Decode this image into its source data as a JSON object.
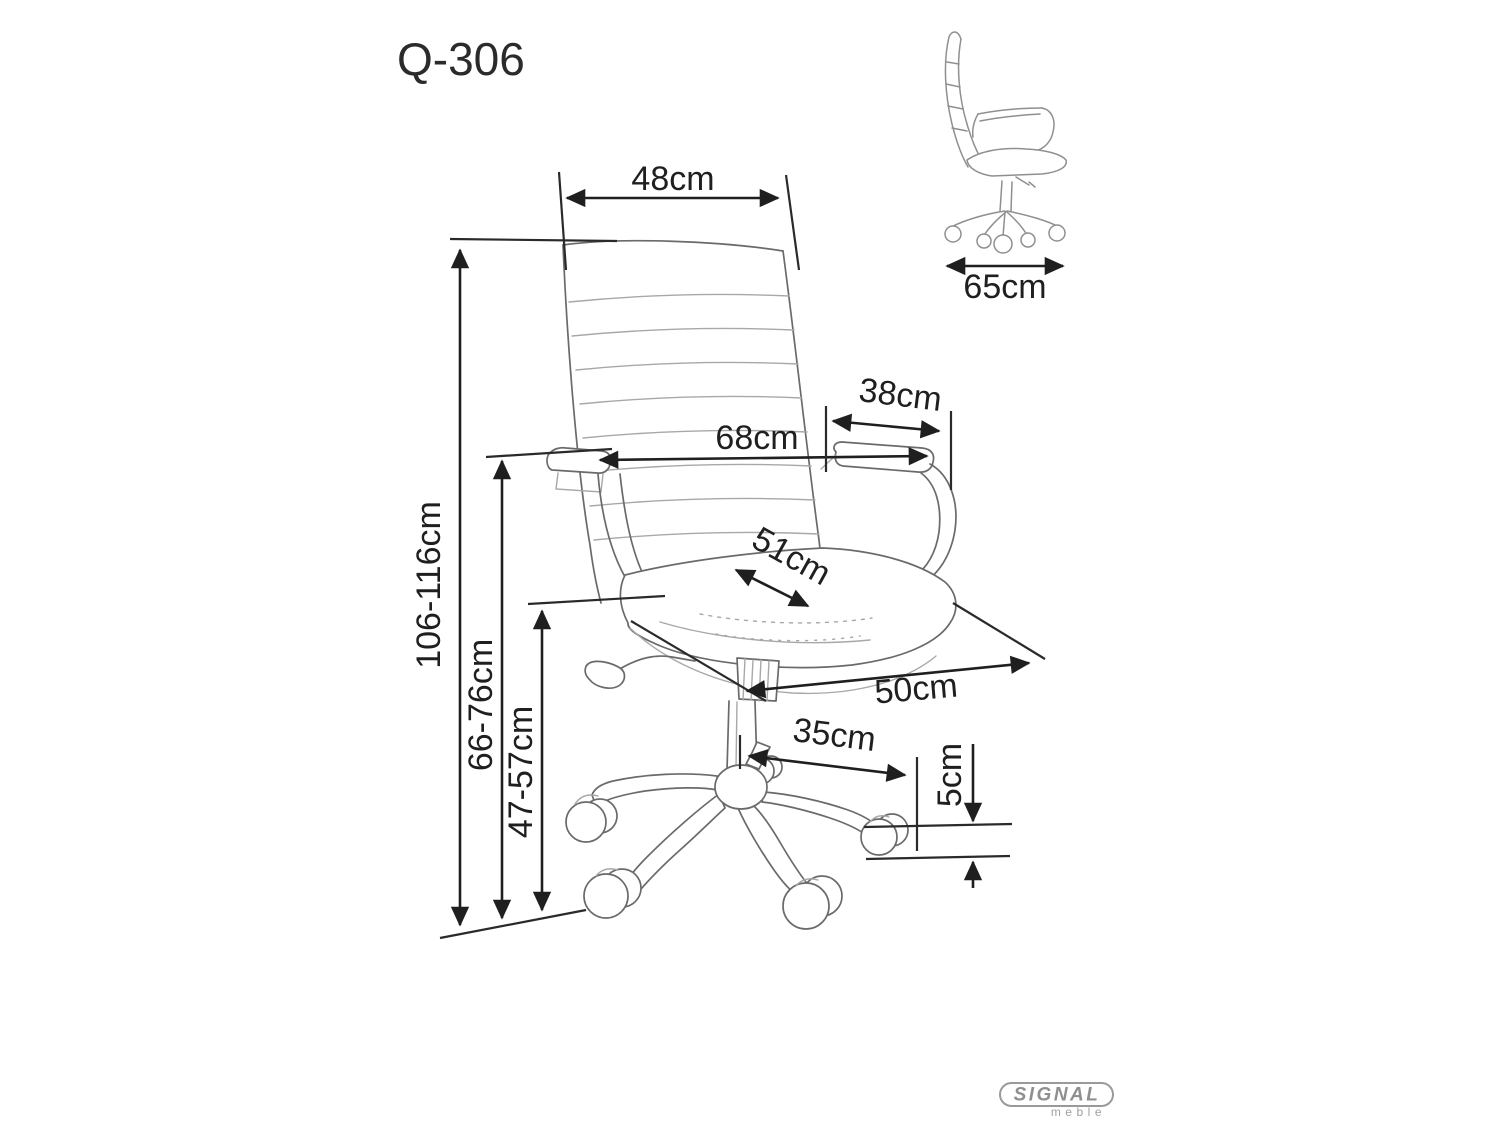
{
  "title": "Q-306",
  "front_view": {
    "back_width": "48cm",
    "armrest_span": "68cm",
    "armrest_length": "38cm",
    "seat_depth": "51cm",
    "seat_width": "50cm",
    "base_leg_reach": "35cm",
    "caster_height": "5cm",
    "total_height": "106-116cm",
    "armrest_height": "66-76cm",
    "seat_height": "47-57cm"
  },
  "side_view": {
    "depth": "65cm"
  },
  "logo": {
    "brand": "SIGNAL",
    "sub": "meble"
  },
  "colors": {
    "dimension_ink": "#1f1f1f",
    "sketch_ink": "#6a6a6a",
    "sketch_light": "#a8a8a8",
    "logo_gray": "#9a9a9a",
    "background": "#ffffff"
  }
}
